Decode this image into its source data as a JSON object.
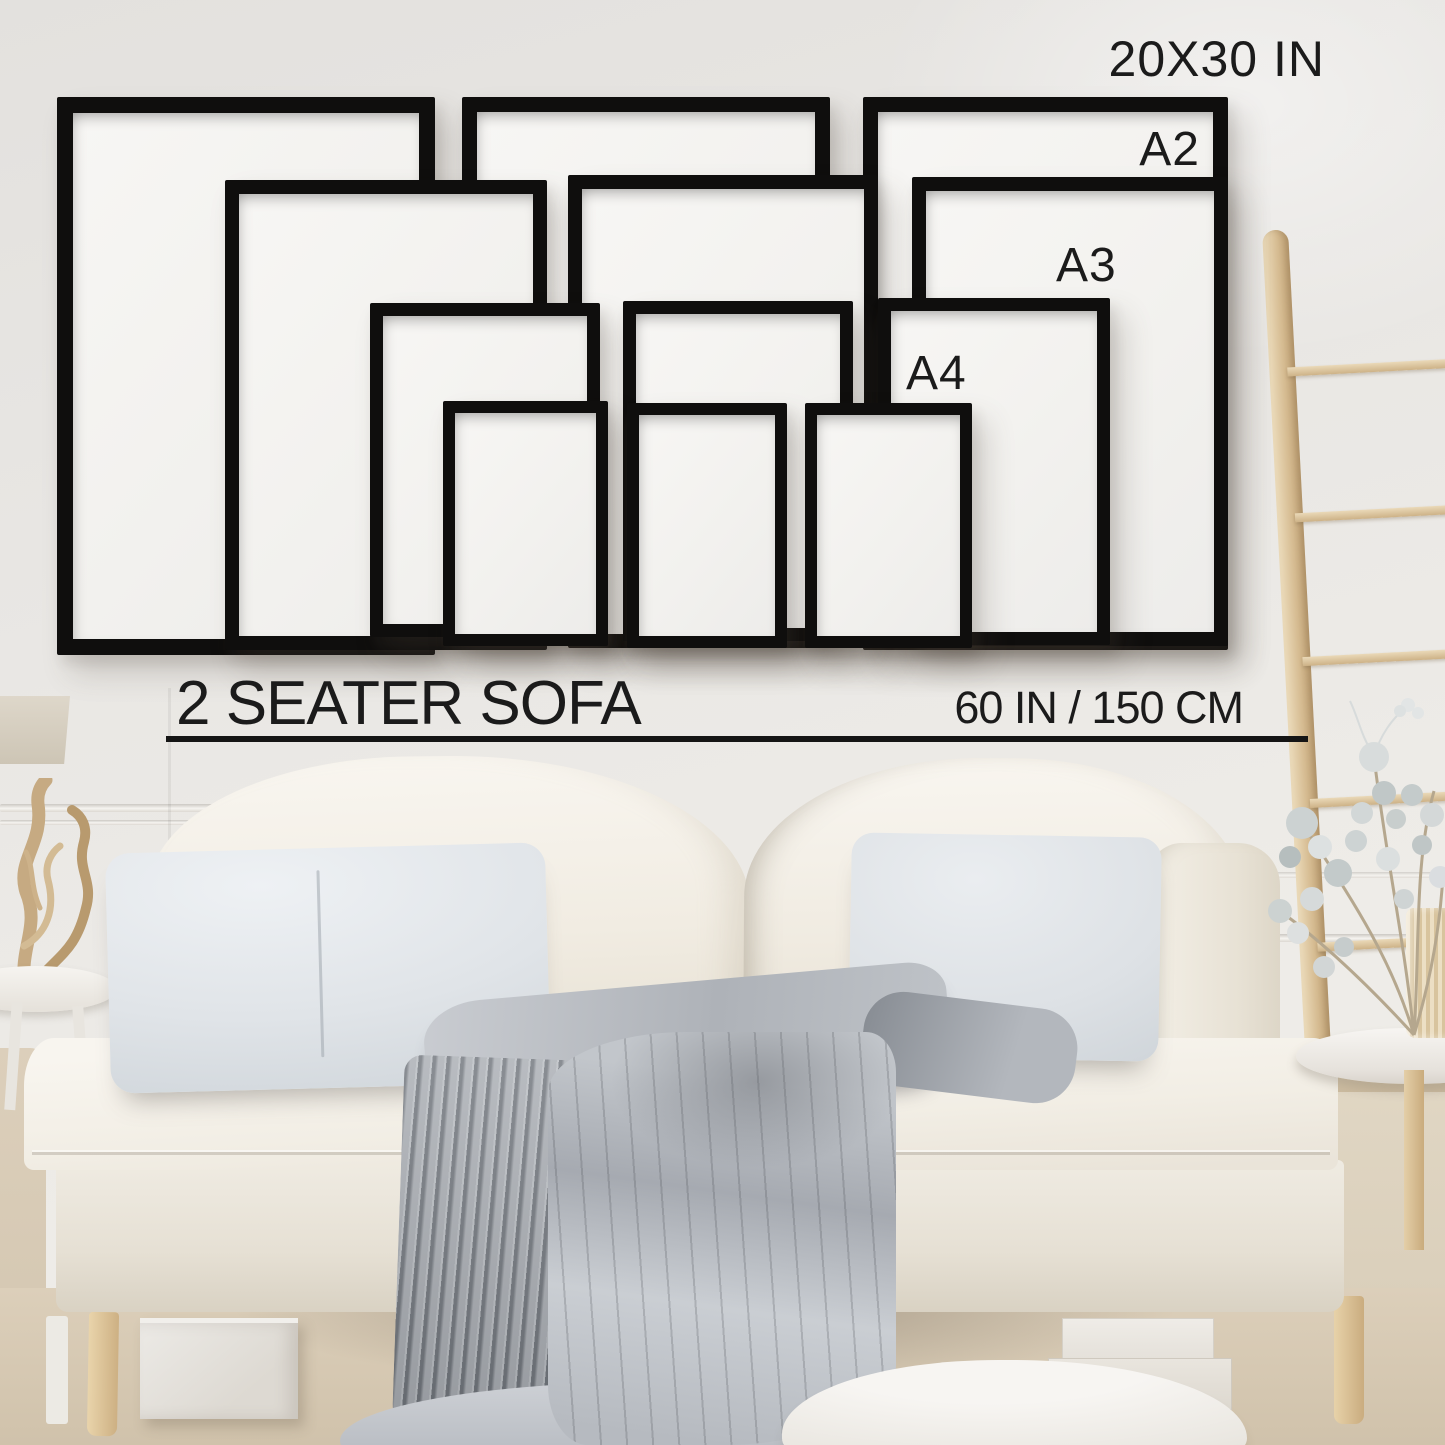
{
  "labels": {
    "largest_size": "20X30 IN",
    "a2": "A2",
    "a3": "A3",
    "a4": "A4",
    "sofa": "2 SEATER SOFA",
    "sofa_width": "60 IN / 150 CM"
  },
  "frames": [
    {
      "id": "20x30-left",
      "size": "20X30 IN",
      "x": 57,
      "y": 97,
      "w": 378,
      "h": 558,
      "b": 16
    },
    {
      "id": "20x30-middle",
      "size": "20X30 IN",
      "x": 462,
      "y": 97,
      "w": 368,
      "h": 546,
      "b": 15
    },
    {
      "id": "20x30-right",
      "size": "20X30 IN",
      "x": 863,
      "y": 97,
      "w": 365,
      "h": 553,
      "b": 15
    },
    {
      "id": "a2-left",
      "size": "A2",
      "x": 225,
      "y": 180,
      "w": 322,
      "h": 470,
      "b": 14
    },
    {
      "id": "a2-middle",
      "size": "A2",
      "x": 568,
      "y": 175,
      "w": 310,
      "h": 473,
      "b": 14
    },
    {
      "id": "a2-right",
      "size": "A2",
      "x": 912,
      "y": 177,
      "w": 316,
      "h": 469,
      "b": 14
    },
    {
      "id": "a3-left",
      "size": "A3",
      "x": 370,
      "y": 303,
      "w": 230,
      "h": 334,
      "b": 13
    },
    {
      "id": "a3-middle",
      "size": "A3",
      "x": 623,
      "y": 301,
      "w": 230,
      "h": 340,
      "b": 13
    },
    {
      "id": "a3-right",
      "size": "A3",
      "x": 878,
      "y": 298,
      "w": 232,
      "h": 347,
      "b": 13
    },
    {
      "id": "a4-left",
      "size": "A4",
      "x": 443,
      "y": 401,
      "w": 165,
      "h": 245,
      "b": 12
    },
    {
      "id": "a4-middle",
      "size": "A4",
      "x": 627,
      "y": 403,
      "w": 160,
      "h": 245,
      "b": 12
    },
    {
      "id": "a4-right",
      "size": "A4",
      "x": 805,
      "y": 403,
      "w": 167,
      "h": 245,
      "b": 12
    }
  ],
  "ladder": {
    "rungs": [
      368,
      514,
      658,
      800,
      944
    ],
    "top": 230
  },
  "colors": {
    "text": "#1b1b1b",
    "frame": "#0f0e0d",
    "paper": "#f4f3f1",
    "wood": "#dcc49e",
    "wood-dark": "#c2a376",
    "cream": "#f2efe8",
    "cream-dark": "#e3ddd1",
    "pillow": "#dfe3e7",
    "blanket": "#a7abb1",
    "blanket-light": "#ccd0d4",
    "rug": "#d7cab6",
    "underline": "#151515"
  }
}
